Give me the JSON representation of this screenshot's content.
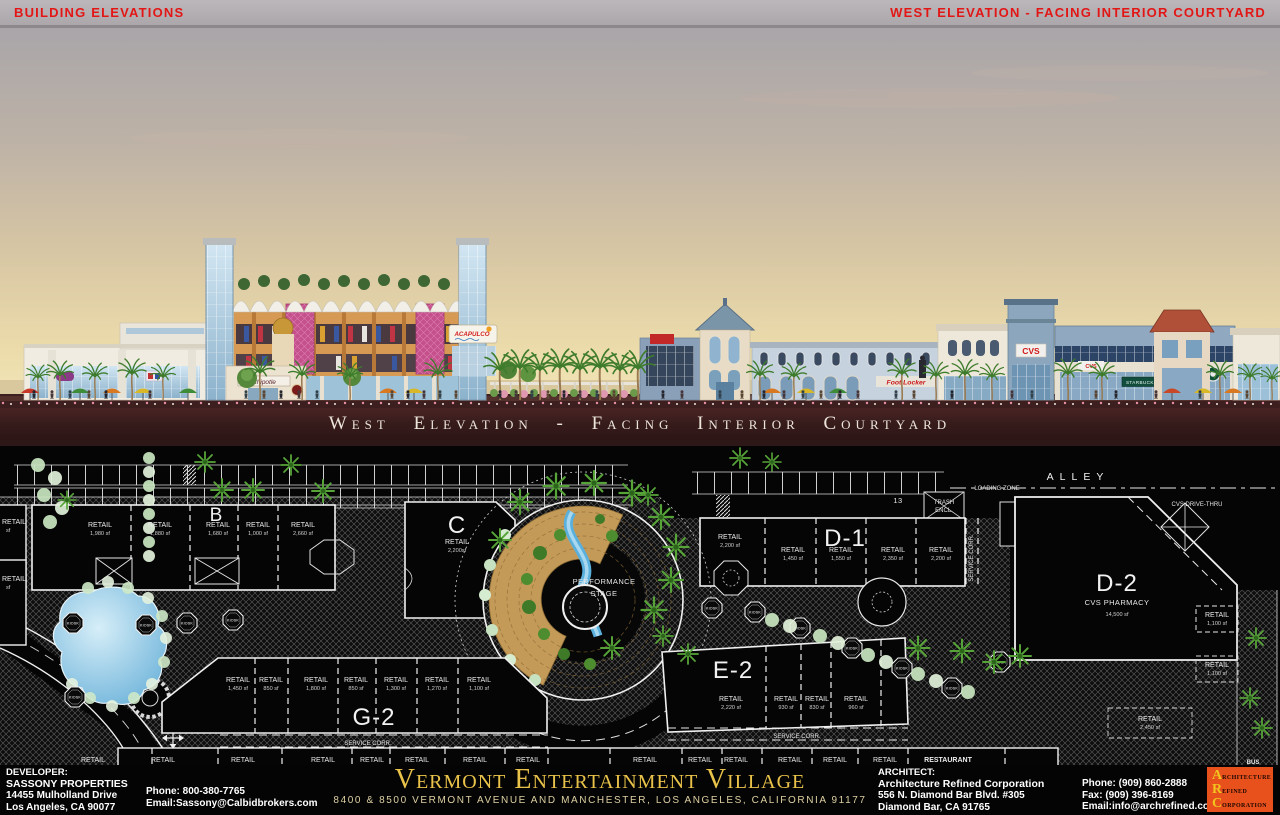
{
  "header": {
    "left_title": "BUILDING ELEVATIONS",
    "right_title": "WEST ELEVATION - FACING INTERIOR COURTYARD"
  },
  "elevation": {
    "caption": "West Elevation - Facing Interior Courtyard",
    "signs": {
      "acapulco": "ACAPULCO",
      "chipotle": "Chipotle",
      "foot_locker": "Foot Locker",
      "cvs_tower": "CVS",
      "cvs_entry": "CVS",
      "starbucks": "STARBUCKS COFFEE"
    }
  },
  "site_plan": {
    "buildings": {
      "b": "B",
      "c": "C",
      "d1": "D-1",
      "d2": "D-2",
      "e2": "E-2",
      "g2": "G-2"
    },
    "d2_tenant": "CVS PHARMACY",
    "d2_size": "14,500 sf",
    "stage_line1": "PERFORMANCE",
    "stage_line2": "STAGE",
    "alley": "ALLEY",
    "loading_zone": "LOADING ZONE",
    "drive_thru": "CVS DRIVE-THRU",
    "trash_line1": "TRASH",
    "trash_line2": "ENCL.",
    "parking_count": "13",
    "service_corridor": "SERVICE CORR.",
    "kiosk": "KIOSK",
    "bus": "BUS",
    "retail_word": "RETAIL",
    "restaurant_word": "RESTAURANT",
    "sf_word": "sf",
    "units": [
      {
        "name": "RETAIL",
        "size": "1,980 sf"
      },
      {
        "name": "RETAIL",
        "size": "1,880 sf"
      },
      {
        "name": "RETAIL",
        "size": "1,680 sf"
      },
      {
        "name": "RETAIL",
        "size": "1,000 sf"
      },
      {
        "name": "RETAIL",
        "size": "2,660 sf"
      },
      {
        "name": "RETAIL",
        "size": "2,200sf"
      },
      {
        "name": "RETAIL",
        "size": "2,200 sf"
      },
      {
        "name": "RETAIL",
        "size": "1,450 sf"
      },
      {
        "name": "RETAIL",
        "size": "1,550 sf"
      },
      {
        "name": "RETAIL",
        "size": "2,350 sf"
      },
      {
        "name": "RETAIL",
        "size": "2,200 sf"
      },
      {
        "name": "RETAIL",
        "size": "1,100 sf"
      },
      {
        "name": "RETAIL",
        "size": "2,220 sf"
      },
      {
        "name": "RETAIL",
        "size": "930 sf"
      },
      {
        "name": "RETAIL",
        "size": "830 sf"
      },
      {
        "name": "RETAIL",
        "size": "960 sf"
      },
      {
        "name": "RETAIL",
        "size": "1,450 sf"
      },
      {
        "name": "RETAIL",
        "size": "850 sf"
      },
      {
        "name": "RETAIL",
        "size": "1,800 sf"
      },
      {
        "name": "RETAIL",
        "size": "850 sf"
      },
      {
        "name": "RETAIL",
        "size": "1,300 sf"
      },
      {
        "name": "RETAIL",
        "size": "1,270 sf"
      },
      {
        "name": "RETAIL",
        "size": "1,100 sf"
      },
      {
        "name": "RETAIL",
        "size": "2,450 sf"
      },
      {
        "name": "RETAIL",
        "size": "1,100 sf"
      }
    ]
  },
  "footer": {
    "developer": {
      "heading": "DEVELOPER:",
      "name": "SASSONY PROPERTIES",
      "address1": "14455 Mulholland Drive",
      "address2": "Los Angeles, CA 90077",
      "phone": "Phone: 800-380-7765",
      "email": "Email:Sassony@Calbidbrokers.com"
    },
    "project": {
      "title": "Vermont Entertainment Village",
      "subtitle": "8400 & 8500 VERMONT AVENUE AND MANCHESTER, LOS ANGELES, CALIFORNIA 91177"
    },
    "architect": {
      "heading": "ARCHITECT:",
      "name": "Architecture Refined Corporation",
      "address1": "556 N. Diamond Bar Blvd.  #305",
      "address2": "Diamond Bar, CA 91765",
      "phone": "Phone: (909) 860-2888",
      "fax": "Fax: (909) 396-8169",
      "email": "Email:info@archrefined.com"
    },
    "logo": {
      "letter1": "A",
      "word1": "RCHITECTURE",
      "letter2": "R",
      "word2": "EFINED",
      "letter3": "C",
      "word3": "ORPORATION"
    }
  }
}
